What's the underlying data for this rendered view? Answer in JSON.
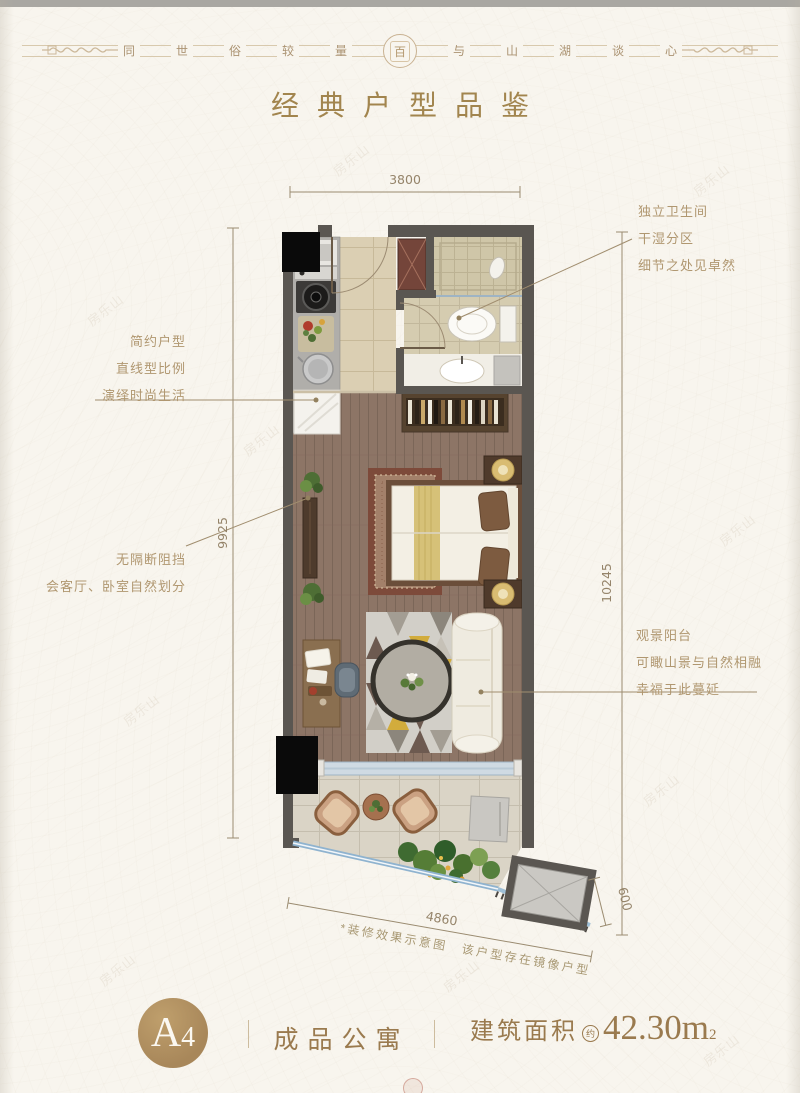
{
  "header": {
    "slogan_left": [
      "同",
      "世",
      "俗",
      "较",
      "量"
    ],
    "seal_char": "百",
    "slogan_right": [
      "与",
      "山",
      "湖",
      "谈",
      "心"
    ],
    "title": "经典户型品鉴"
  },
  "annotations": {
    "left_top": [
      "简约户型",
      "直线型比例",
      "演绎时尚生活"
    ],
    "left_bottom": [
      "无隔断阻挡",
      "会客厅、卧室自然划分"
    ],
    "right_top": [
      "独立卫生间",
      "干湿分区",
      "细节之处见卓然"
    ],
    "right_bottom": [
      "观景阳台",
      "可瞰山景与自然相融",
      "幸福于此蔓延"
    ]
  },
  "dimensions": {
    "top": "3800",
    "left": "9925",
    "right": "10245",
    "bottom": "4860",
    "platform": "600"
  },
  "disclaimer": "*装修效果示意图　该户型存在镜像户型",
  "footer": {
    "unit_letter": "A",
    "unit_number": "4",
    "type_label": "成品公寓",
    "area_label": "建筑面积",
    "approx": "约",
    "area_value": "42.30m",
    "area_exp": "2"
  },
  "watermark": "房乐山",
  "colors": {
    "accent": "#a2854e",
    "wall": "#5a5651",
    "annotation": "#b09770",
    "badge": "#ad8c5c",
    "background": "#f8f5ee"
  }
}
